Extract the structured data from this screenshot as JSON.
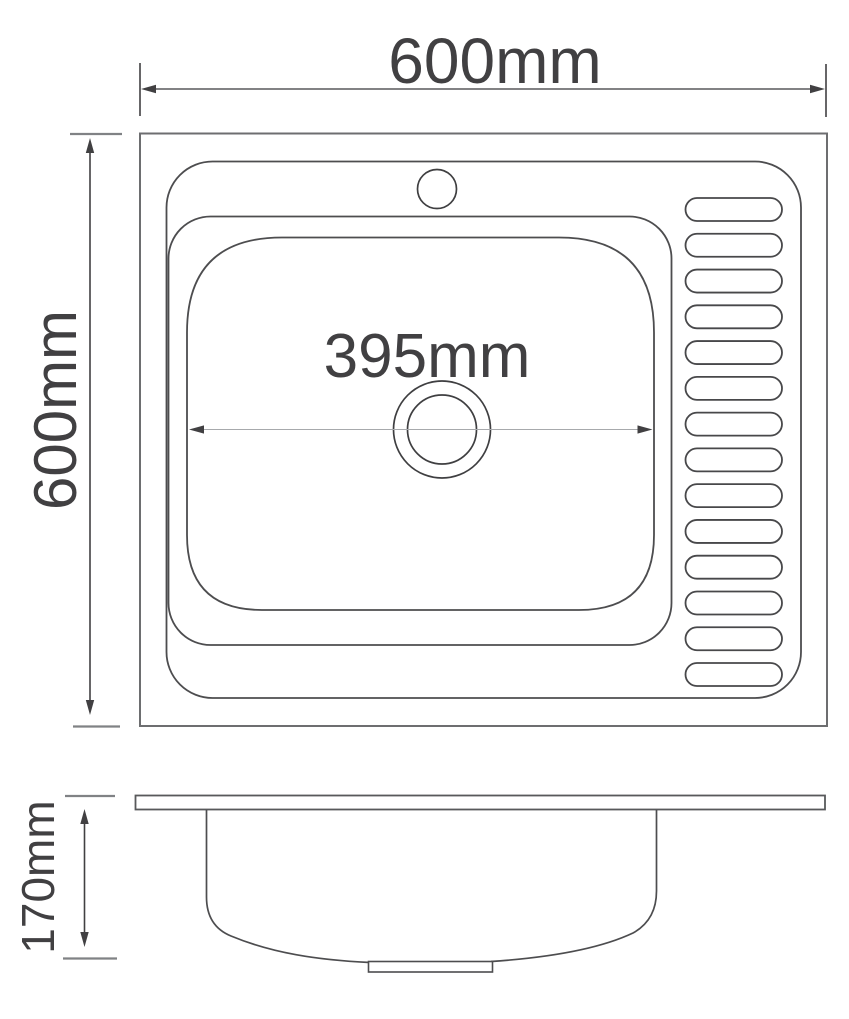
{
  "drawing": {
    "dimensions": {
      "overall_width": "600mm",
      "overall_depth": "600mm",
      "bowl_width": "395mm",
      "bowl_depth": "170mm"
    },
    "top_view": {
      "drainboard_slot_count": 14,
      "faucet_hole_count": 1,
      "drain_hole_count": 1
    },
    "colors": {
      "background": "#ffffff",
      "outline": "#6d6e70",
      "detail_line": "#4d4d4f",
      "dimension_text": "#414042",
      "thin_dimension_line": "#a7a9ac",
      "tick": "#808285"
    }
  }
}
